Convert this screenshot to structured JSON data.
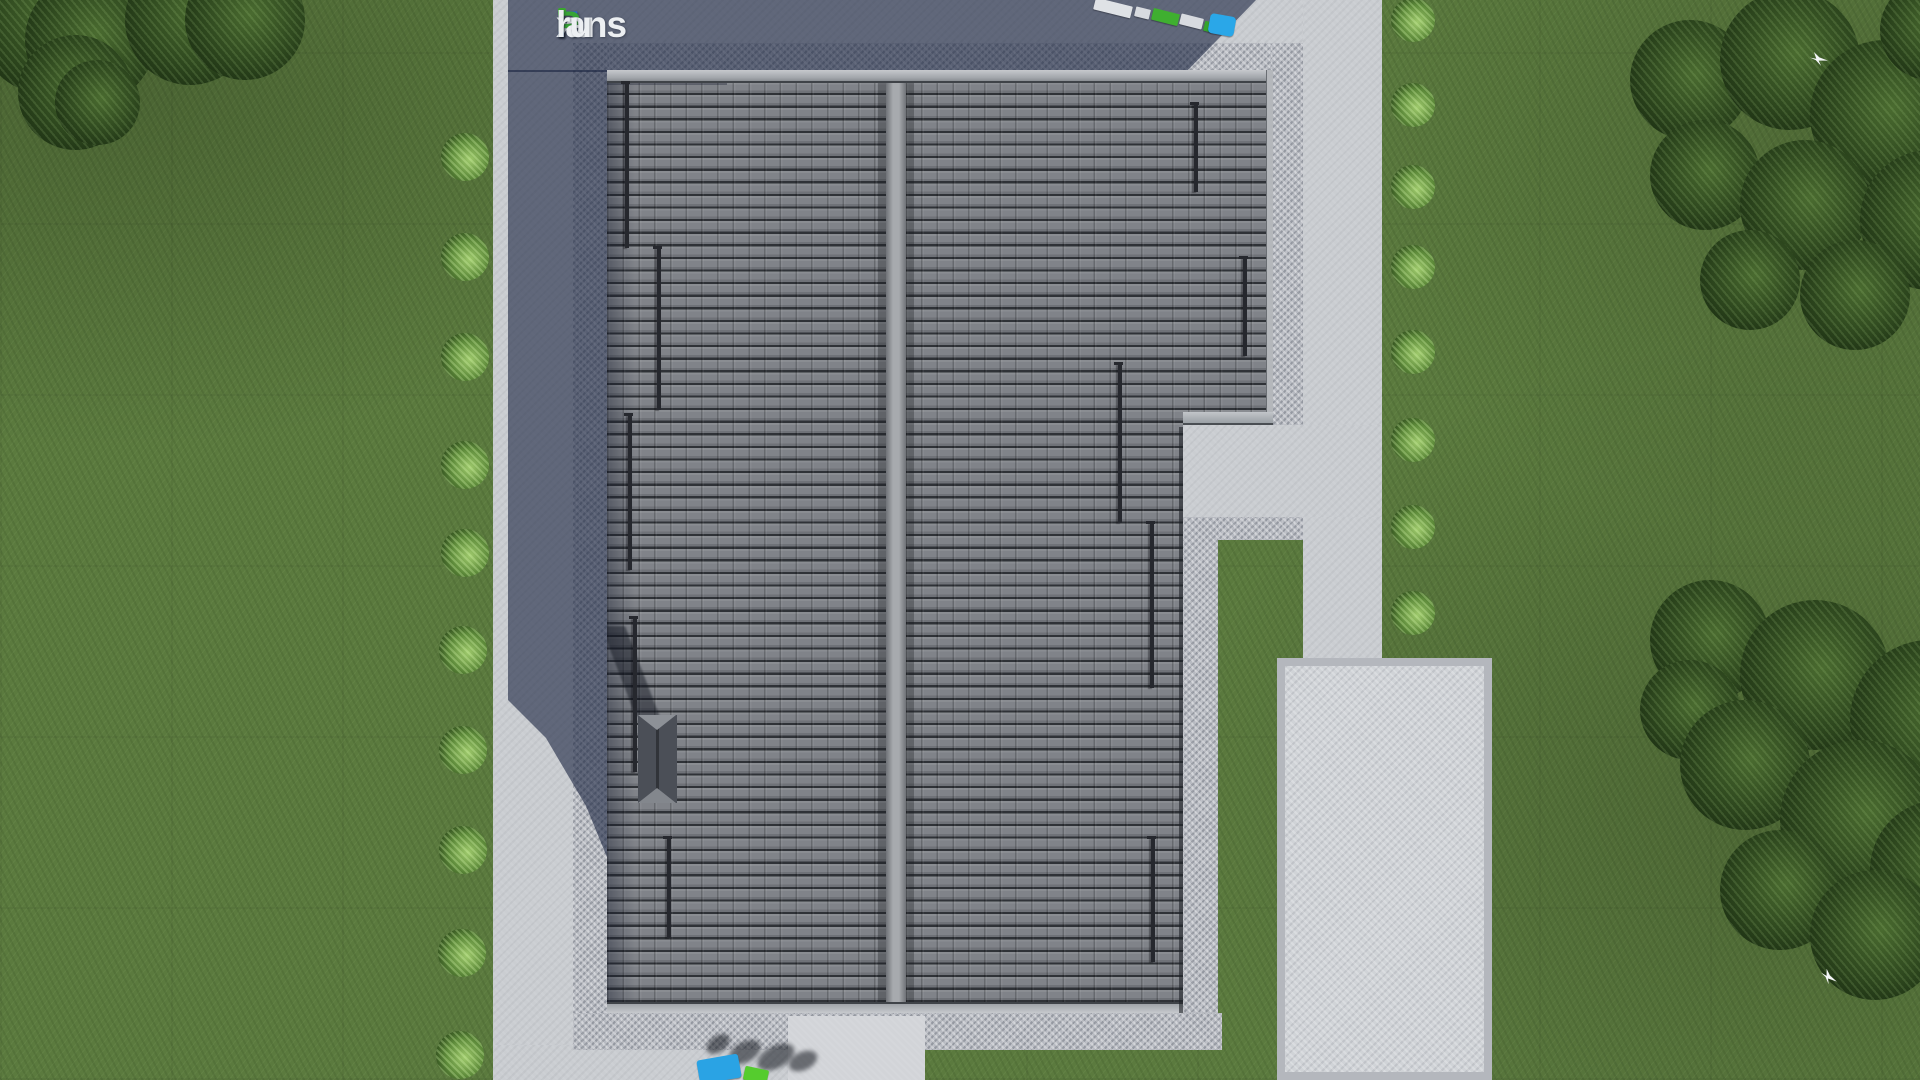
{
  "logo": {
    "text": "FixPlans.ru",
    "segments": [
      {
        "text": "F",
        "color": "#2d6cd2"
      },
      {
        "text": "i",
        "color": "#ecEFf2",
        "dot": "#3aa82f"
      },
      {
        "text": "x",
        "color": "#eceff2"
      },
      {
        "text": "P",
        "color": "#37a435"
      },
      {
        "text": "lans",
        "color": "#eceff2"
      },
      {
        "text": ".",
        "color": "#2d6cd2"
      },
      {
        "text": "ru",
        "color": "#eceff2"
      }
    ]
  },
  "palette": {
    "grass": "#5b7a3e",
    "concrete": "#cacdd1",
    "gravel": "#b7bac1",
    "shadow": "rgba(25,35,64,0.60)",
    "tileGap": "#2f3237",
    "objectBlue": "#2aa7e8",
    "objectGreen": "#46bb2e",
    "logoBlue": "#2d6cd2",
    "logoGreen": "#37a435"
  },
  "scene": {
    "description": "Top-down 3D render of a house roof plan on a lawn with paths, gravel aprons, hedges and trees",
    "groups": [
      {
        "name": "hedge-bush",
        "cls": "bush",
        "parent": "#stage",
        "items": [
          {
            "x": 441,
            "y": 133,
            "d": 48
          },
          {
            "x": 441,
            "y": 233,
            "d": 48
          },
          {
            "x": 441,
            "y": 333,
            "d": 48
          },
          {
            "x": 441,
            "y": 441,
            "d": 48
          },
          {
            "x": 441,
            "y": 529,
            "d": 48
          },
          {
            "x": 439,
            "y": 626,
            "d": 48
          },
          {
            "x": 439,
            "y": 726,
            "d": 48
          },
          {
            "x": 439,
            "y": 826,
            "d": 48
          },
          {
            "x": 438,
            "y": 929,
            "d": 48
          },
          {
            "x": 436,
            "y": 1031,
            "d": 48
          },
          {
            "x": 1391,
            "y": -2,
            "d": 44
          },
          {
            "x": 1391,
            "y": 83,
            "d": 44
          },
          {
            "x": 1391,
            "y": 165,
            "d": 44
          },
          {
            "x": 1391,
            "y": 245,
            "d": 44
          },
          {
            "x": 1391,
            "y": 330,
            "d": 44
          },
          {
            "x": 1391,
            "y": 418,
            "d": 44
          },
          {
            "x": 1391,
            "y": 505,
            "d": 44
          },
          {
            "x": 1391,
            "y": 591,
            "d": 44
          }
        ]
      },
      {
        "name": "tree",
        "cls": "tree",
        "parent": "#stage",
        "items": [
          {
            "x": -25,
            "y": -55,
            "d": 150
          },
          {
            "x": 25,
            "y": -25,
            "d": 130
          },
          {
            "x": 18,
            "y": 35,
            "d": 115
          },
          {
            "x": 125,
            "y": -45,
            "d": 130
          },
          {
            "x": 185,
            "y": -40,
            "d": 120
          },
          {
            "x": 55,
            "y": 60,
            "d": 85
          },
          {
            "x": 1630,
            "y": 20,
            "d": 120
          },
          {
            "x": 1720,
            "y": -10,
            "d": 140
          },
          {
            "x": 1810,
            "y": 40,
            "d": 150
          },
          {
            "x": 1880,
            "y": -20,
            "d": 100
          },
          {
            "x": 1650,
            "y": 120,
            "d": 110
          },
          {
            "x": 1740,
            "y": 140,
            "d": 130
          },
          {
            "x": 1860,
            "y": 150,
            "d": 140
          },
          {
            "x": 1700,
            "y": 230,
            "d": 100
          },
          {
            "x": 1800,
            "y": 240,
            "d": 110
          },
          {
            "x": 1650,
            "y": 580,
            "d": 120
          },
          {
            "x": 1740,
            "y": 600,
            "d": 150
          },
          {
            "x": 1850,
            "y": 640,
            "d": 160
          },
          {
            "x": 1640,
            "y": 660,
            "d": 100
          },
          {
            "x": 1680,
            "y": 700,
            "d": 130
          },
          {
            "x": 1780,
            "y": 740,
            "d": 160
          },
          {
            "x": 1870,
            "y": 800,
            "d": 140
          },
          {
            "x": 1720,
            "y": 830,
            "d": 120
          },
          {
            "x": 1810,
            "y": 870,
            "d": 130
          }
        ]
      },
      {
        "name": "snow-guard-rail",
        "cls": "rail",
        "parent": "#house",
        "items": [
          {
            "x": 18,
            "y": 13,
            "w": 4,
            "h": 165
          },
          {
            "x": 50,
            "y": 178,
            "w": 4,
            "h": 162
          },
          {
            "x": 21,
            "y": 345,
            "w": 4,
            "h": 155
          },
          {
            "x": 26,
            "y": 548,
            "w": 4,
            "h": 154
          },
          {
            "x": 60,
            "y": 768,
            "w": 4,
            "h": 100
          },
          {
            "x": 587,
            "y": 34,
            "w": 4,
            "h": 88
          },
          {
            "x": 636,
            "y": 188,
            "w": 4,
            "h": 98
          },
          {
            "x": 511,
            "y": 294,
            "w": 4,
            "h": 159
          },
          {
            "x": 543,
            "y": 453,
            "w": 4,
            "h": 165
          },
          {
            "x": 544,
            "y": 768,
            "w": 4,
            "h": 124
          }
        ]
      },
      {
        "name": "yard-object-shadow",
        "cls": "blob",
        "parent": "#stage",
        "items": [
          {
            "x": 705,
            "y": 1036,
            "w": 26,
            "h": 16,
            "rot": -35
          },
          {
            "x": 728,
            "y": 1042,
            "w": 34,
            "h": 20,
            "rot": -30
          },
          {
            "x": 756,
            "y": 1046,
            "w": 40,
            "h": 22,
            "rot": -28
          },
          {
            "x": 788,
            "y": 1052,
            "w": 30,
            "h": 18,
            "rot": -25
          }
        ]
      },
      {
        "name": "yard-object",
        "cls": "prop",
        "parent": "#stage",
        "items": [
          {
            "x": 1094,
            "y": 2,
            "w": 38,
            "h": 12,
            "c": "#dfe2e6",
            "rot": 14,
            "br": 1
          },
          {
            "x": 1135,
            "y": 8,
            "w": 15,
            "h": 10,
            "c": "#d8dbe0",
            "rot": 14,
            "br": 1
          },
          {
            "x": 1152,
            "y": 11,
            "w": 27,
            "h": 12,
            "c": "#3faf30",
            "rot": 14,
            "br": 1
          },
          {
            "x": 1180,
            "y": 16,
            "w": 23,
            "h": 11,
            "c": "#d8dbe0",
            "rot": 14,
            "br": 1
          },
          {
            "x": 1204,
            "y": 22,
            "w": 11,
            "h": 10,
            "c": "#35a42c",
            "rot": 14,
            "br": 1
          },
          {
            "x": 1209,
            "y": 15,
            "w": 26,
            "h": 20,
            "c": "#2aa7e8",
            "rot": 10,
            "br": 4
          },
          {
            "x": 698,
            "y": 1057,
            "w": 42,
            "h": 24,
            "c": "#2aa3e4",
            "rot": -10,
            "br": 3
          },
          {
            "x": 744,
            "y": 1068,
            "w": 24,
            "h": 14,
            "c": "#55cc2e",
            "rot": 12,
            "br": 2
          }
        ]
      },
      {
        "name": "white-bird",
        "cls": "bird",
        "parent": "#stage",
        "items": [
          {
            "x": 1810,
            "y": 52,
            "w": 18,
            "h": 14
          },
          {
            "x": 1820,
            "y": 970,
            "w": 18,
            "h": 14,
            "rot": 20
          }
        ]
      }
    ]
  }
}
